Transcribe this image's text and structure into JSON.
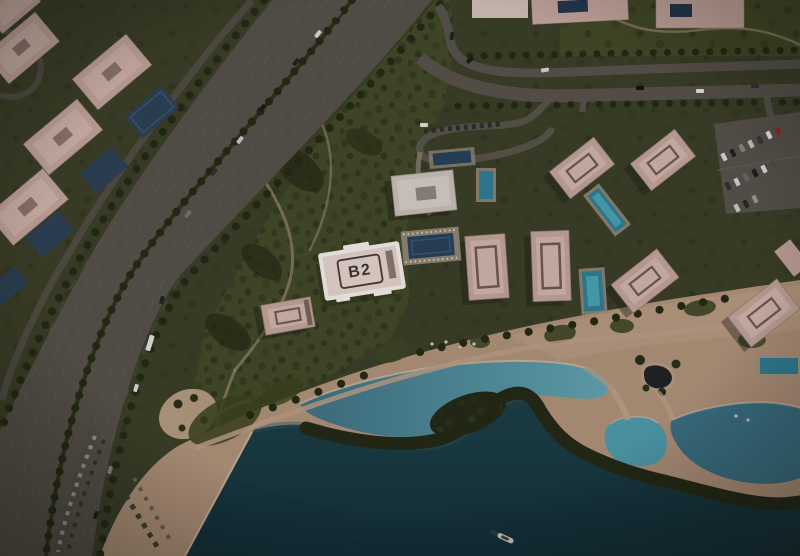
{
  "map": {
    "view": "aerial-masterplan-render",
    "selected_building": {
      "label": "B2"
    },
    "colors": {
      "highlight-outline": "#f8f3ef",
      "highlight-fill": "#e9d7d1",
      "label-text": "#3e3833",
      "terrain": "#3a3f26",
      "park": "#444c2a",
      "sand": "#b2957c",
      "promenade": "#bda188",
      "lagoon": "#3e7385",
      "lagoon-bright": "#62a7b6",
      "sea": "#1b4049",
      "sea-deep": "#12303a",
      "road": "#56524a",
      "building-roof": "#c7a99f",
      "building-roof-light": "#d6bbb1",
      "pool-cyan": "#2f8298",
      "pool-dark": "#27415a"
    }
  }
}
